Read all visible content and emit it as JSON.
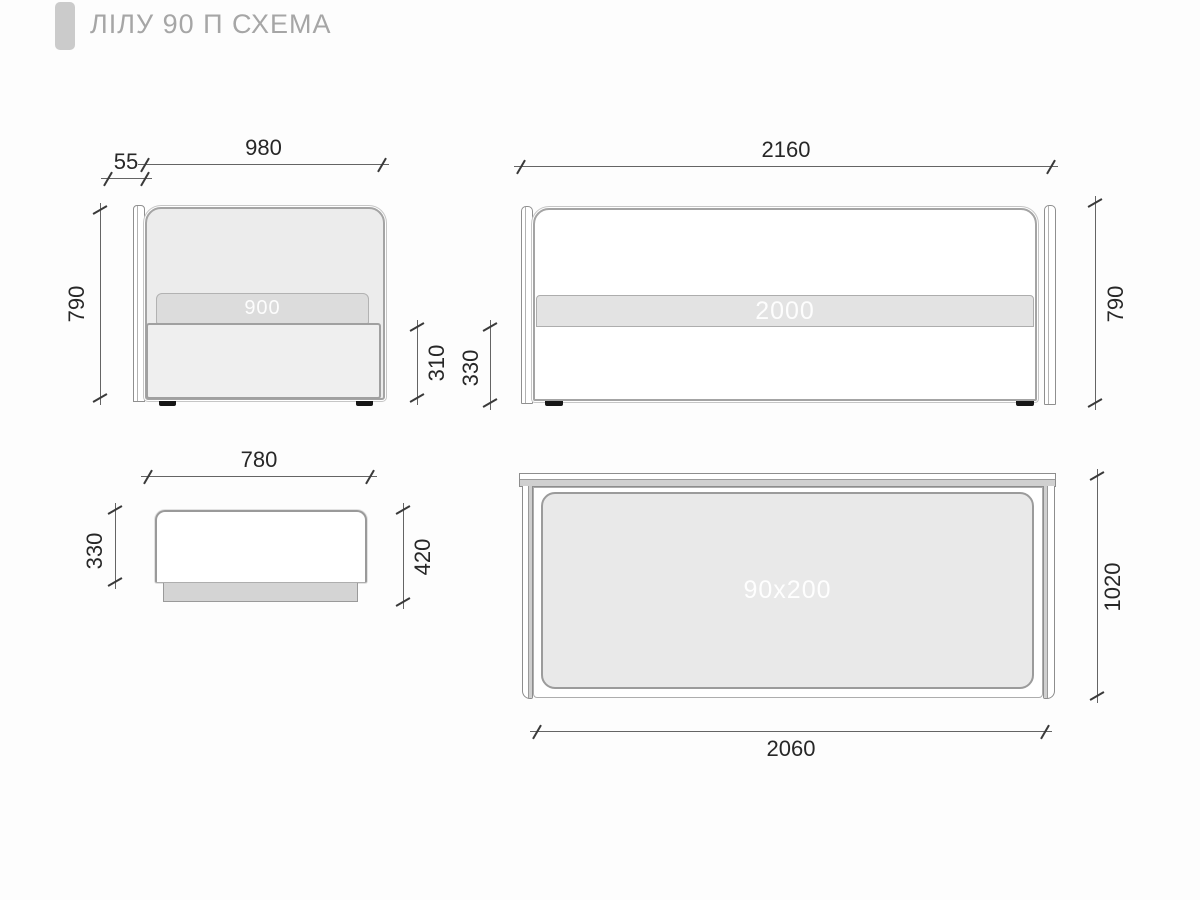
{
  "title": "ЛІЛУ 90 П СХЕМА",
  "front_view": {
    "dim_width": "980",
    "dim_backrest": "55",
    "dim_height": "790",
    "dim_base_height": "310",
    "mattress_label": "900"
  },
  "side_view": {
    "dim_length": "2160",
    "dim_height": "790",
    "dim_base_height": "330",
    "mattress_label": "2000"
  },
  "bench_view": {
    "dim_width": "780",
    "dim_height": "330",
    "dim_total_height": "420"
  },
  "plan_view": {
    "dim_length": "2060",
    "dim_width": "1020",
    "mattress_label": "90x200"
  },
  "colors": {
    "background": "#fdfdfd",
    "accent_bar": "#cbcbcb",
    "title_text": "#a6a6a6",
    "dim_line": "#646464",
    "dim_text": "#272727",
    "panel_fill": "#ececec",
    "mattress_fill_front": "#dcdcdc",
    "mattress_fill_side": "#e3e3e3",
    "mattress_fill_plan": "#e9e9e9",
    "mattress_label_text": "#ffffff",
    "feet": "#161616"
  }
}
